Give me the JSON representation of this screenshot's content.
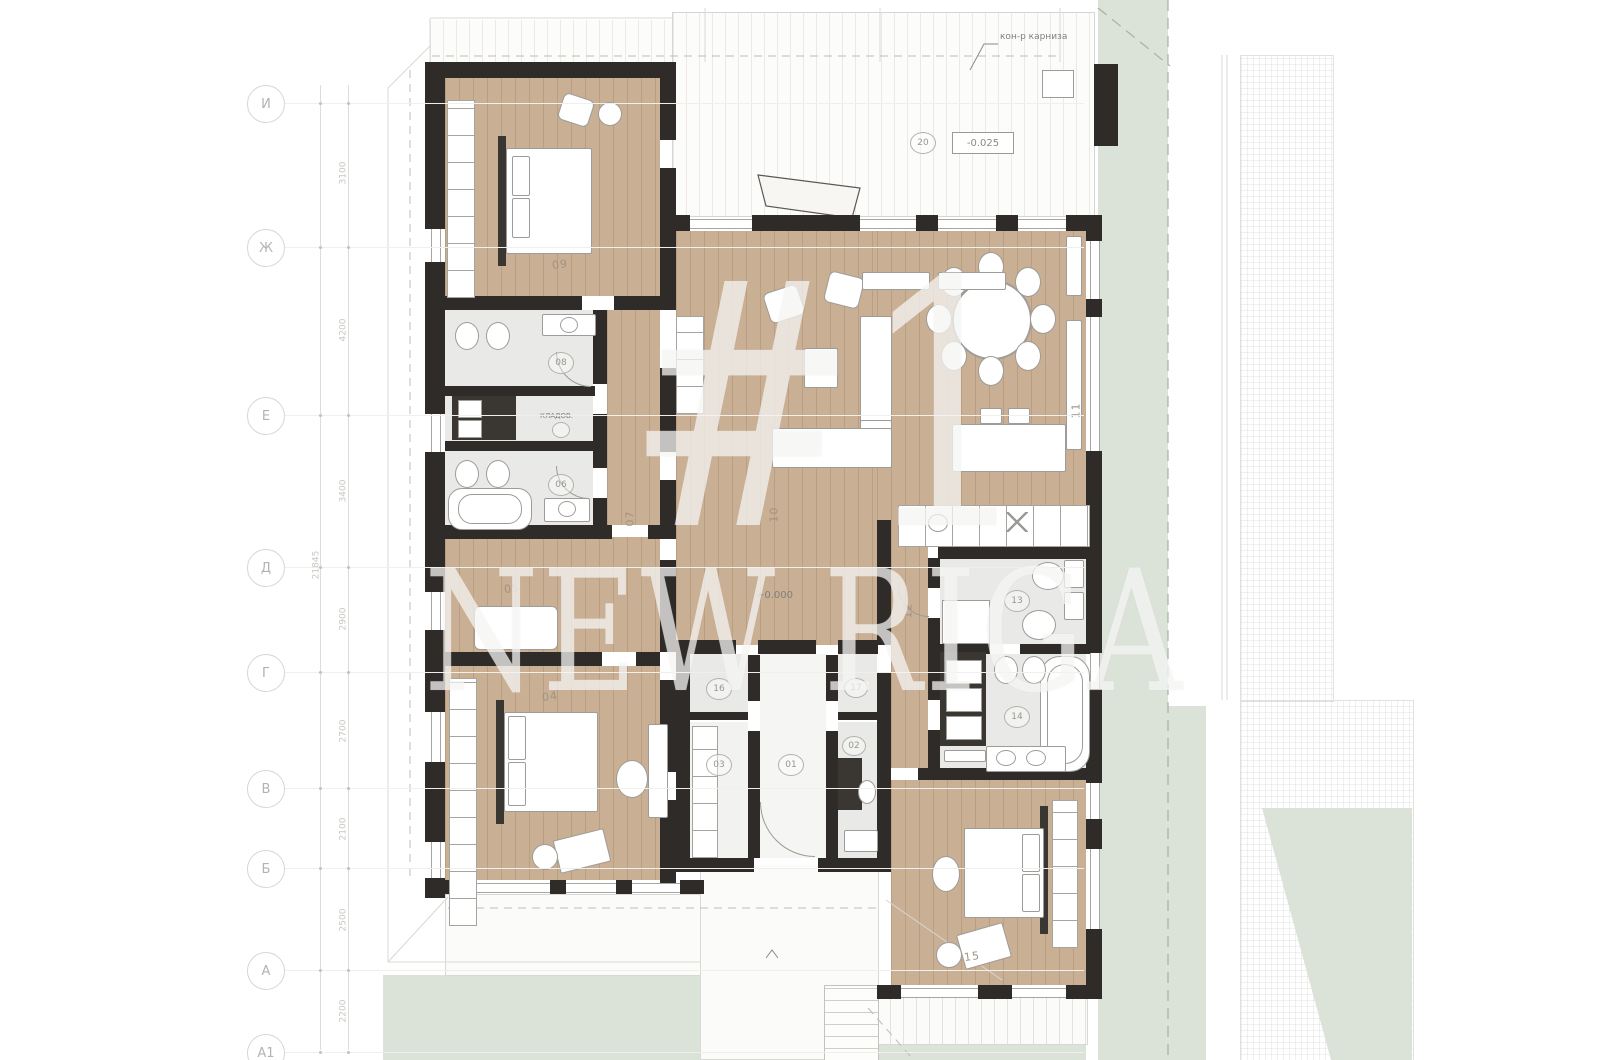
{
  "watermark": {
    "line1": "#1",
    "line2": "NEW RIGA"
  },
  "annotations": {
    "cornice": "кон-р карниза",
    "storage": "КЛАДОВ.",
    "level_terrace": "-0.025",
    "level_floor": "+0.000"
  },
  "axes": [
    {
      "label": "И"
    },
    {
      "label": "Ж"
    },
    {
      "label": "Е"
    },
    {
      "label": "Д"
    },
    {
      "label": "Г"
    },
    {
      "label": "В"
    },
    {
      "label": "Б"
    },
    {
      "label": "А"
    },
    {
      "label": "А1"
    }
  ],
  "dimensions": {
    "segments": [
      "3100",
      "4200",
      "3400",
      "2900",
      "2700",
      "2100",
      "2500",
      "2200"
    ],
    "total": "21845"
  },
  "rooms": [
    {
      "number": "20",
      "circled": true
    },
    {
      "number": "09",
      "circled": false
    },
    {
      "number": "08",
      "circled": true
    },
    {
      "number": "06",
      "circled": true
    },
    {
      "number": "07",
      "circled": false
    },
    {
      "number": "10",
      "circled": false
    },
    {
      "number": "11",
      "circled": false
    },
    {
      "number": "05",
      "circled": false
    },
    {
      "number": "04",
      "circled": false
    },
    {
      "number": "03",
      "circled": true
    },
    {
      "number": "01",
      "circled": true
    },
    {
      "number": "02",
      "circled": true
    },
    {
      "number": "16",
      "circled": true
    },
    {
      "number": "17",
      "circled": true
    },
    {
      "number": "12",
      "circled": false
    },
    {
      "number": "13",
      "circled": true
    },
    {
      "number": "14",
      "circled": true
    },
    {
      "number": "15",
      "circled": false
    }
  ],
  "colors": {
    "wood_floor": "#c9af94",
    "wall": "#2e2b28",
    "bath_floor": "#e9e9e7",
    "green_landscape": "#dbe2d8",
    "deck": "#fcfcfa",
    "label_gray": "#98968f",
    "watermark": "rgba(255,255,255,0.62)"
  }
}
